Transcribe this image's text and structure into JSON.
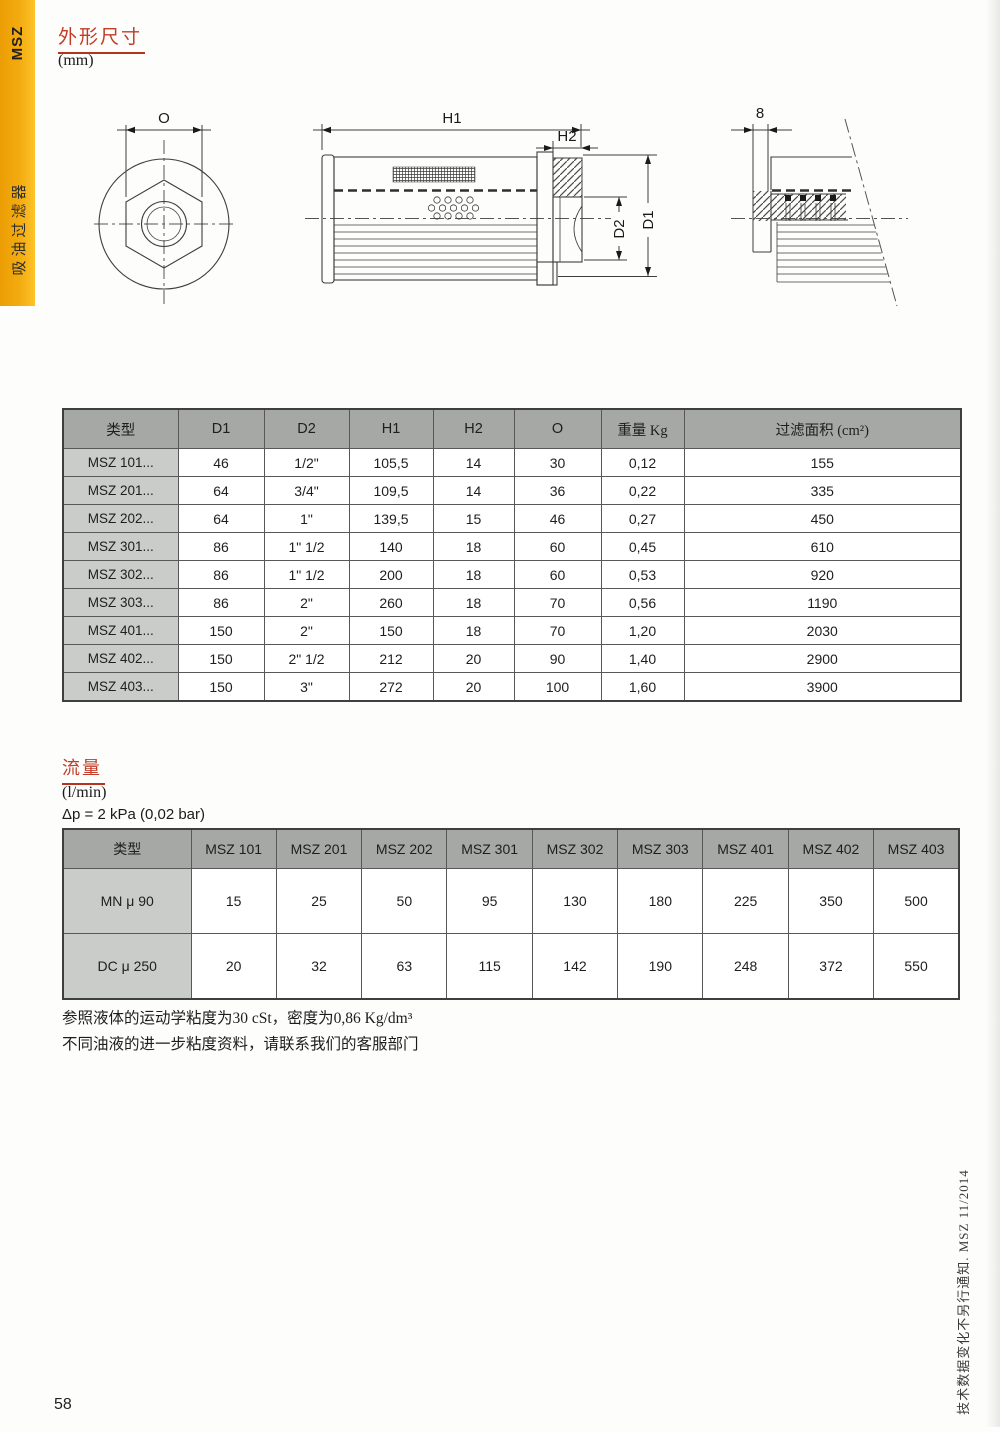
{
  "sidebar": {
    "series": "MSZ",
    "product": "吸油过滤器"
  },
  "dimensions_section": {
    "title": "外形尺寸",
    "unit": "(mm)"
  },
  "drawing": {
    "labels": {
      "o": "O",
      "h1": "H1",
      "h2": "H2",
      "d1": "D1",
      "d2": "D2",
      "wall": "8"
    }
  },
  "dim_table": {
    "headers": [
      "类型",
      "D1",
      "D2",
      "H1",
      "H2",
      "O",
      "重量 Kg",
      "过滤面积 (cm²)"
    ],
    "rows": [
      {
        "label": "MSZ 101...",
        "values": [
          "46",
          "1/2\"",
          "105,5",
          "14",
          "30",
          "0,12",
          "155"
        ]
      },
      {
        "label": "MSZ 201...",
        "values": [
          "64",
          "3/4\"",
          "109,5",
          "14",
          "36",
          "0,22",
          "335"
        ]
      },
      {
        "label": "MSZ 202...",
        "values": [
          "64",
          "1\"",
          "139,5",
          "15",
          "46",
          "0,27",
          "450"
        ]
      },
      {
        "label": "MSZ 301...",
        "values": [
          "86",
          "1\" 1/2",
          "140",
          "18",
          "60",
          "0,45",
          "610"
        ]
      },
      {
        "label": "MSZ 302...",
        "values": [
          "86",
          "1\" 1/2",
          "200",
          "18",
          "60",
          "0,53",
          "920"
        ]
      },
      {
        "label": "MSZ 303...",
        "values": [
          "86",
          "2\"",
          "260",
          "18",
          "70",
          "0,56",
          "1190"
        ]
      },
      {
        "label": "MSZ 401...",
        "values": [
          "150",
          "2\"",
          "150",
          "18",
          "70",
          "1,20",
          "2030"
        ]
      },
      {
        "label": "MSZ 402...",
        "values": [
          "150",
          "2\" 1/2",
          "212",
          "20",
          "90",
          "1,40",
          "2900"
        ]
      },
      {
        "label": "MSZ 403...",
        "values": [
          "150",
          "3\"",
          "272",
          "20",
          "100",
          "1,60",
          "3900"
        ]
      }
    ]
  },
  "flow_section": {
    "title": "流量",
    "unit": "(l/min)",
    "condition": "Δp = 2 kPa (0,02 bar)"
  },
  "flow_table": {
    "headers": [
      "类型",
      "MSZ 101",
      "MSZ 201",
      "MSZ 202",
      "MSZ 301",
      "MSZ 302",
      "MSZ 303",
      "MSZ 401",
      "MSZ 402",
      "MSZ 403"
    ],
    "rows": [
      {
        "label": "MN μ 90",
        "values": [
          "15",
          "25",
          "50",
          "95",
          "130",
          "180",
          "225",
          "350",
          "500"
        ]
      },
      {
        "label": "DC μ 250",
        "values": [
          "20",
          "32",
          "63",
          "115",
          "142",
          "190",
          "248",
          "372",
          "550"
        ]
      }
    ]
  },
  "notes": {
    "line1": "参照液体的运动学粘度为30 cSt，密度为0,86 Kg/dm³",
    "line2": "不同油液的进一步粘度资料，请联系我们的客服部门"
  },
  "footer": {
    "page_number": "58",
    "side_note": "技术数据变化不另行通知. MSZ 11/2014"
  },
  "colors": {
    "accent_red": "#c23b27",
    "strip_orange": "#f3ab10",
    "table_header_gray": "#a5a8a4",
    "row_label_gray": "#c9ccc8"
  }
}
